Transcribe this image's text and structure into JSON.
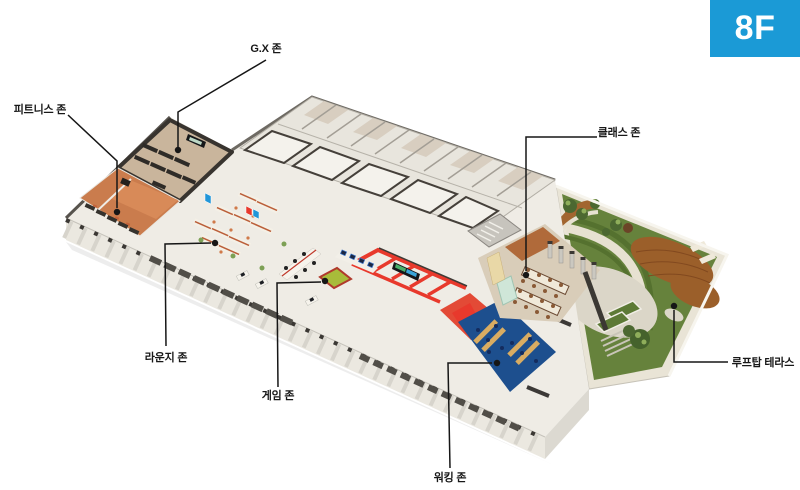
{
  "floor_badge": {
    "label": "8F",
    "color": "#1b9ad6"
  },
  "zones": [
    {
      "id": "gx",
      "label": "G.X 존"
    },
    {
      "id": "fitness",
      "label": "피트니스 존"
    },
    {
      "id": "class",
      "label": "클래스 존"
    },
    {
      "id": "lounge",
      "label": "라운지 존"
    },
    {
      "id": "game",
      "label": "게임 존"
    },
    {
      "id": "working",
      "label": "워킹 존"
    },
    {
      "id": "rooftop",
      "label": "루프탑 테라스"
    }
  ],
  "palette": {
    "badge_blue": "#1b9ad6",
    "label_text": "#181818",
    "floor_base": "#efece5",
    "game_red": "#e8392c",
    "working_navy": "#1d4f8e",
    "terrace_turf": "#66823c",
    "terrace_wood": "#9b5f2a",
    "fitness_terracotta": "#ca7c4d",
    "pool_table_green": "#a8bc3a",
    "studio_wall_charcoal": "#38342f"
  }
}
